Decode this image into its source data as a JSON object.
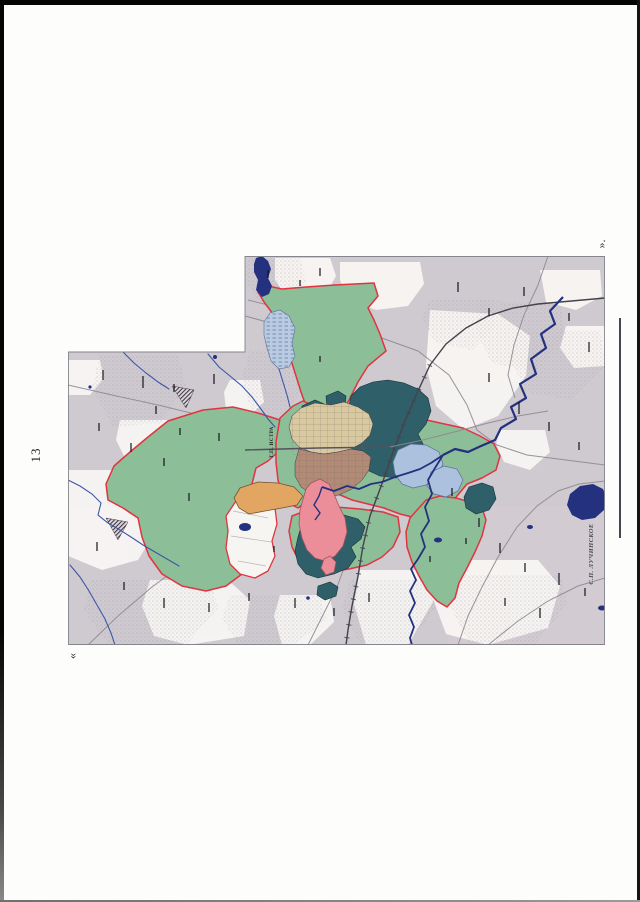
{
  "page": {
    "number": "13"
  },
  "marks": {
    "left_quote": "«",
    "right_quote": "»."
  },
  "map": {
    "labels": {
      "town": "Г.П. ИСТРА",
      "district": "С.П. ЛУЧИНСКОЕ"
    },
    "colors": {
      "topo_background": "#cfc9d0",
      "white_patch": "#f8f6f3",
      "settlement_zone_green": "#8cbe98",
      "industrial_zone_teal": "#2f5f68",
      "builtup_tan": "#d9c9a1",
      "builtup_brown": "#b28b76",
      "recreation_zone_pink": "#ec8e99",
      "zone_orange": "#e2a562",
      "zone_lightblue": "#abc1dd",
      "marsh_lightblue": "#b9cbe2",
      "water_navy": "#24317f",
      "boundary_red": "#e03440",
      "road_gray": "#8f8791",
      "railway_dark": "#45424c"
    }
  }
}
